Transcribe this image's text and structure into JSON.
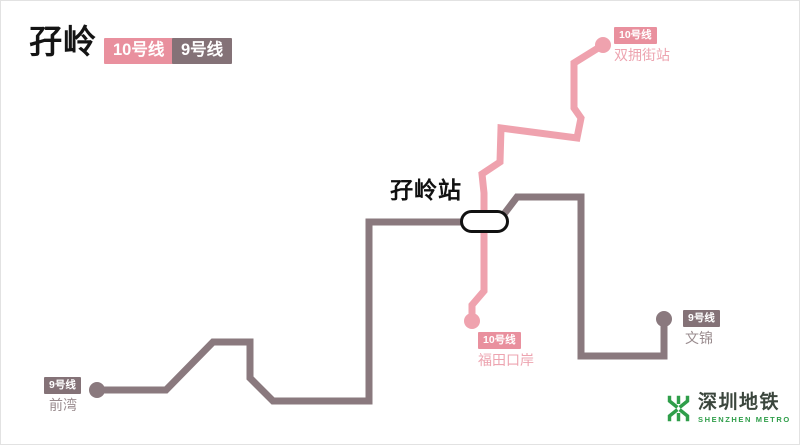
{
  "header": {
    "title": "孖岭",
    "line_badges": [
      {
        "label": "10号线",
        "color": "#e9909e"
      },
      {
        "label": "9号线",
        "color": "#847277"
      }
    ]
  },
  "map": {
    "interchange_station": {
      "name": "孖岭站"
    },
    "stations": [
      {
        "line": "10号线",
        "name": "双拥街站"
      },
      {
        "line": "10号线",
        "name": "福田口岸"
      },
      {
        "line": "9号线",
        "name": "前湾"
      },
      {
        "line": "9号线",
        "name": "文锦"
      }
    ],
    "lines": [
      {
        "name": "10号线",
        "color": "#efa2ae"
      },
      {
        "name": "9号线",
        "color": "#8a797e"
      }
    ],
    "interchange_marker": {
      "fill": "#ffffff",
      "border": "#111111"
    }
  },
  "logo": {
    "name_cn": "深圳地铁",
    "name_en": "SHENZHEN METRO",
    "color": "#2f9e4a"
  }
}
